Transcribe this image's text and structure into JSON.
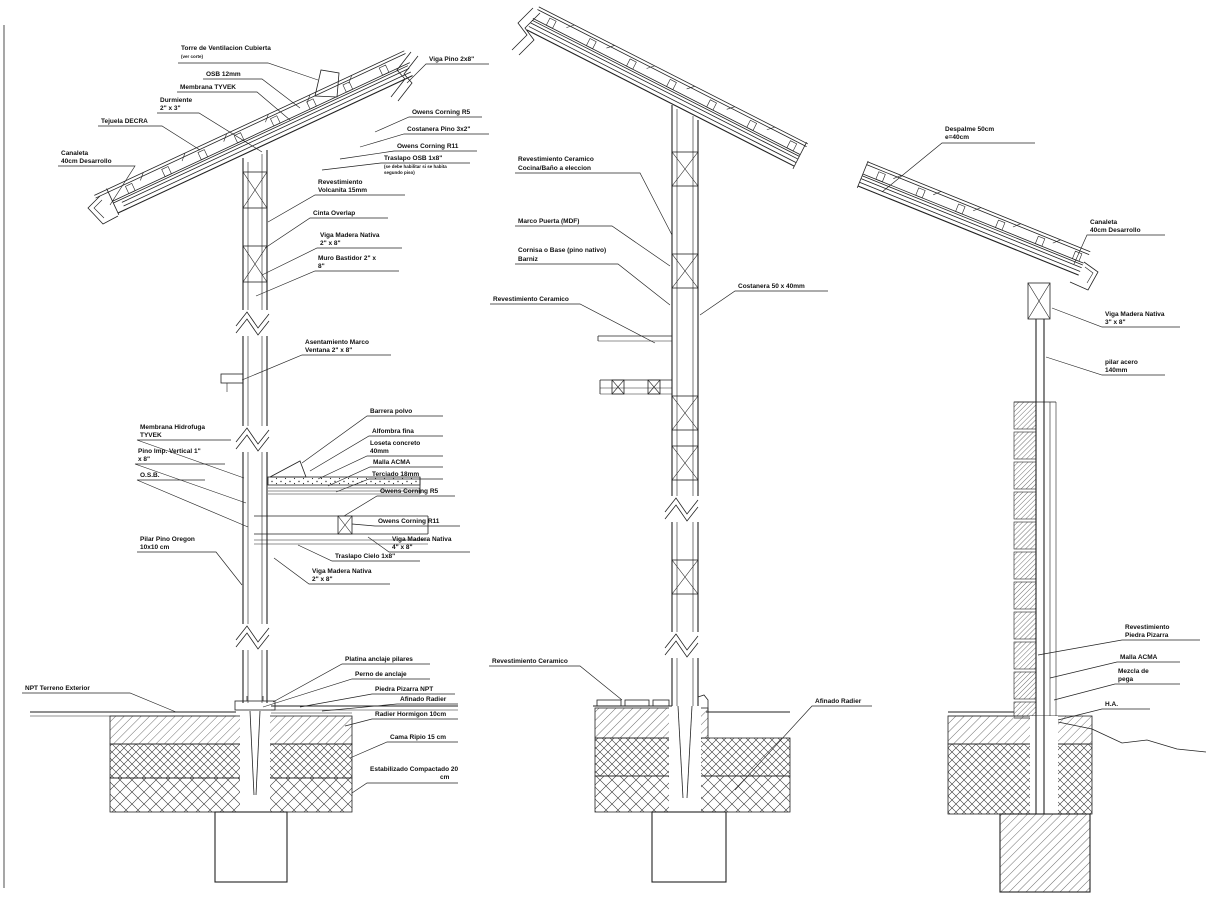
{
  "colors": {
    "background": "#ffffff",
    "line": "#222222",
    "text": "#111111"
  },
  "d1": {
    "torre_1": "Torre de Ventilacion Cubierta",
    "torre_2": "(ver corte)",
    "osb12": "OSB 12mm",
    "membrana_tyvek": "Membrana TYVEK",
    "durmiente_1": "Durmiente",
    "durmiente_2": "2\" x 3\"",
    "tejuela": "Tejuela DECRA",
    "canaleta_1": "Canaleta",
    "canaleta_2": "40cm Desarrollo",
    "viga_pino": "Viga Pino 2x8\"",
    "oc_r5_roof": "Owens Corning R5",
    "costanera_pino": "Costanera Pino 3x2\"",
    "oc_r11_roof": "Owens Corning R11",
    "traslapo_osb_1": "Traslapo OSB 1x8\"",
    "traslapo_osb_2": "(se debe habilitar si se habita",
    "traslapo_osb_3": "segundo piso)",
    "rev_volcanita_1": "Revestimiento",
    "rev_volcanita_2": "Volcanita 15mm",
    "cinta_overlap": "Cinta Overlap",
    "viga_nativa_a_1": "Viga Madera Nativa",
    "viga_nativa_a_2": "2\" x 8\"",
    "muro_bastidor_1": "Muro Bastidor 2\" x",
    "muro_bastidor_2": "8\"",
    "asent_marco_1": "Asentamiento Marco",
    "asent_marco_2": "Ventana 2\" x 8\"",
    "memb_hidro_1": "Membrana Hidrofuga",
    "memb_hidro_2": "TYVEK",
    "pino_imp_1": "Pino Imp. Vertical 1\"",
    "pino_imp_2": "x 8\"",
    "osb_abbr": "O.S.B.",
    "barrera_polvo": "Barrera polvo",
    "alfombra": "Alfombra fina",
    "loseta_1": "Loseta concreto",
    "loseta_2": "40mm",
    "malla_acma": "Malla ACMA",
    "terciado": "Terciado 18mm",
    "oc_r5_floor": "Owens Corning R5",
    "oc_r11_floor": "Owens Corning R11",
    "viga_nativa_b_1": "Viga Madera Nativa",
    "viga_nativa_b_2": "4\" x 8\"",
    "traslapo_cielo": "Traslapo Cielo 1x8\"",
    "viga_nativa_c_1": "Viga Madera Nativa",
    "viga_nativa_c_2": "2\" x 8\"",
    "pilar_pino_1": "Pilar Pino Oregon",
    "pilar_pino_2": "10x10 cm",
    "npt_terreno": "NPT Terreno Exterior",
    "platina": "Platina anclaje pilares",
    "perno": "Perno de anclaje",
    "piedra_npt": "Piedra Pizarra NPT",
    "afinado": "Afinado Radier",
    "radier_horm": "Radier Hormigon 10cm",
    "cama_ripio": "Cama Ripio 15 cm",
    "estab_1": "Estabilizado Compactado 20",
    "estab_2": "cm"
  },
  "d2": {
    "rev_cer_top_1": "Revestimiento Ceramico",
    "rev_cer_top_2": "Cocina/Baño a eleccion",
    "marco_puerta": "Marco Puerta (MDF)",
    "cornisa_1": "Cornisa o Base (pino nativo)",
    "cornisa_2": "Barniz",
    "rev_cer_mid": "Revestimiento Ceramico",
    "costanera50": "Costanera 50 x 40mm",
    "rev_cer_bot": "Revestimiento Ceramico",
    "afinado": "Afinado Radier"
  },
  "d3": {
    "despalme_1": "Despalme 50cm",
    "despalme_2": "e=40cm",
    "canaleta_1": "Canaleta",
    "canaleta_2": "40cm Desarrollo",
    "viga_nativa_1": "Viga Madera Nativa",
    "viga_nativa_2": "3\" x 8\"",
    "pilar_acero_1": "pilar acero",
    "pilar_acero_2": "140mm",
    "rev_piedra_1": "Revestimiento",
    "rev_piedra_2": "Piedra Pizarra",
    "malla_acma": "Malla ACMA",
    "mezcla_1": "Mezcla de",
    "mezcla_2": "pega",
    "ha": "H.A."
  }
}
